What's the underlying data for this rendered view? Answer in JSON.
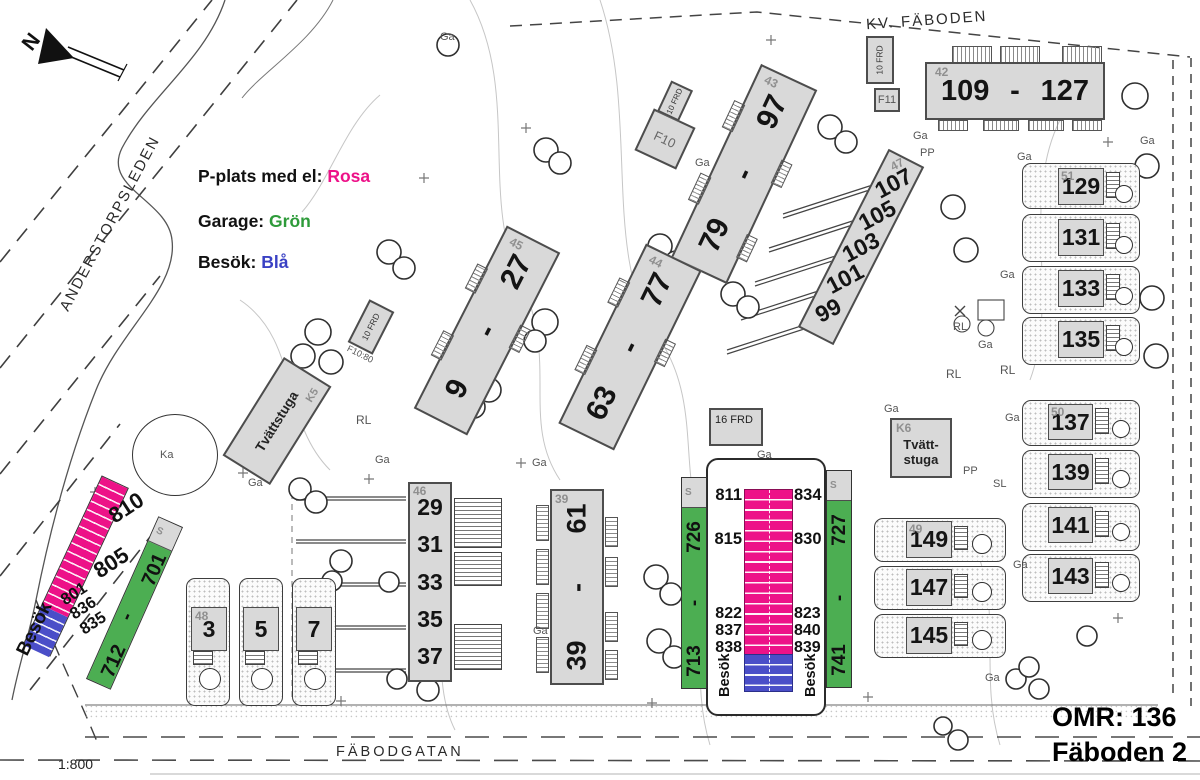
{
  "colors": {
    "pink": "#ED1288",
    "green": "#4CAE52",
    "blue": "#4A4EC8",
    "building_fill": "#D9D9D9"
  },
  "north": {
    "label": "N"
  },
  "legend": {
    "pplats_label": "P-plats med el:",
    "pplats_value": "Rosa",
    "garage_label": "Garage:",
    "garage_value": "Grön",
    "besok_label": "Besök:",
    "besok_value": "Blå"
  },
  "streets": {
    "west": "ANDERSTORPSLEDEN",
    "south": "FÄBODGATAN",
    "block": "KV. FÄBODEN"
  },
  "scale": "1:800",
  "title": {
    "line1": "OMR: 136",
    "line2": "Fäboden 2"
  },
  "b42": {
    "corner": "42",
    "left": "109",
    "sep": "-",
    "right": "127"
  },
  "b43": {
    "corner": "43",
    "top": "97",
    "sep": "-",
    "bottom": "79"
  },
  "b44": {
    "corner": "44",
    "top": "77",
    "sep": "-",
    "bottom": "63"
  },
  "b45": {
    "corner": "45",
    "top": "27",
    "sep": "-",
    "bottom": "9"
  },
  "b39": {
    "corner": "39",
    "top": "61",
    "sep": "-",
    "bottom": "39"
  },
  "strip46": {
    "corner": "46",
    "nums": [
      "29",
      "31",
      "33",
      "35",
      "37"
    ]
  },
  "strip47": {
    "corner": "47",
    "nums": [
      "107",
      "105",
      "103",
      "101",
      "99"
    ]
  },
  "houses48": {
    "corner": "48",
    "nums": [
      "3",
      "5",
      "7"
    ]
  },
  "houses49": {
    "corner": "49",
    "nums": [
      "149",
      "147",
      "145"
    ]
  },
  "houses50": {
    "corner": "50",
    "nums": [
      "137",
      "139",
      "141",
      "143"
    ]
  },
  "houses51": {
    "corner": "51",
    "nums": [
      "129",
      "131",
      "133",
      "135"
    ]
  },
  "tvatt_left": {
    "corner": "K5",
    "label": "Tvättstuga"
  },
  "tvatt_right": {
    "corner": "K6",
    "line1": "Tvätt-",
    "line2": "stuga"
  },
  "small": {
    "f10": "F10",
    "f11": "F11",
    "frd10": "10 FRD",
    "frd16": "16 FRD",
    "f1080": "F10:80",
    "s": "S"
  },
  "parking_left": {
    "p1": "810",
    "p2": "805",
    "stack": [
      "801",
      "836",
      "835"
    ],
    "besok": "Besök",
    "g_top": "701",
    "g_sep": "-",
    "g_bottom": "712"
  },
  "parking_center": {
    "left_top": "726",
    "left_sep": "-",
    "left_bottom": "713",
    "right_top": "727",
    "right_sep": "-",
    "right_bottom": "741",
    "l1": "811",
    "l2": "815",
    "l_stack": [
      "822",
      "837",
      "838"
    ],
    "r1": "834",
    "r2": "830",
    "r_stack": [
      "823",
      "840",
      "839"
    ],
    "besok": "Besök"
  },
  "misc": {
    "ga": "Ga",
    "pp": "PP",
    "rl": "RL",
    "sl": "SL",
    "ka": "Ka"
  }
}
